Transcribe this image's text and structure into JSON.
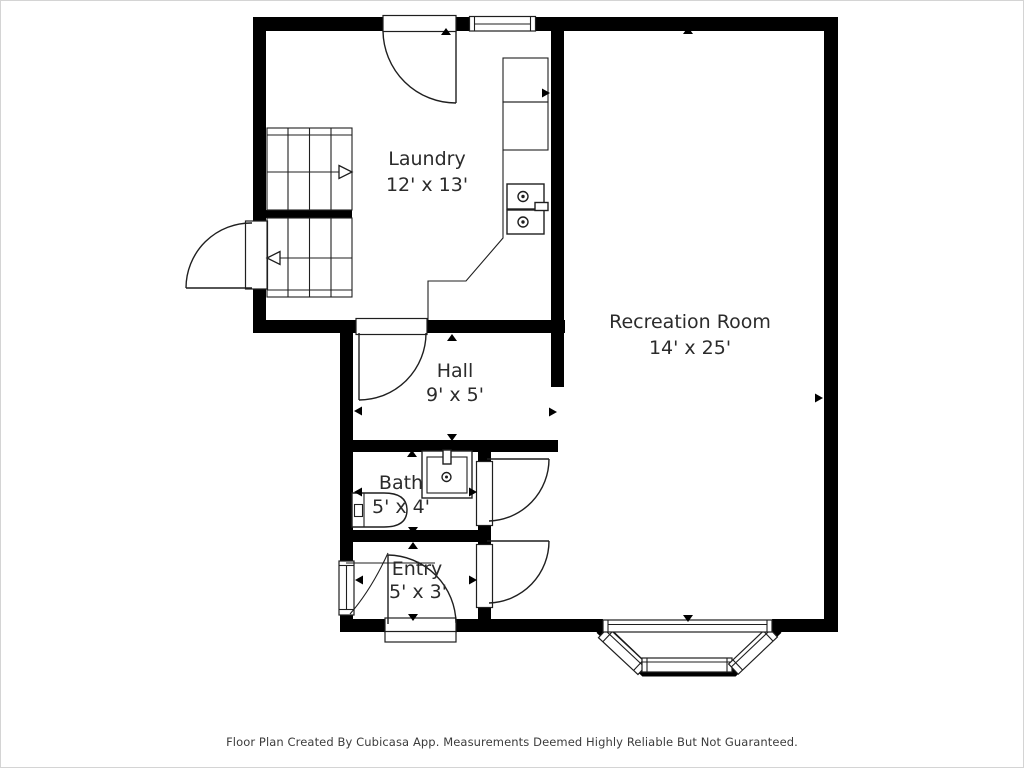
{
  "rooms": {
    "laundry": {
      "name": "Laundry",
      "dims": "12' x 13'"
    },
    "recreation": {
      "name": "Recreation Room",
      "dims": "14' x 25'"
    },
    "hall": {
      "name": "Hall",
      "dims": "9' x 5'"
    },
    "bath": {
      "name": "Bath",
      "dims": "5' x 4'"
    },
    "entry": {
      "name": "Entry",
      "dims": "5' x 3'"
    }
  },
  "footer": {
    "text": "Floor Plan Created By Cubicasa App. Measurements Deemed Highly Reliable But Not Guaranteed."
  },
  "colors": {
    "wall": "#000000",
    "line": "#1f1f1f",
    "text": "#2b2b2b",
    "background": "#ffffff",
    "border": "#d4d4d4"
  }
}
